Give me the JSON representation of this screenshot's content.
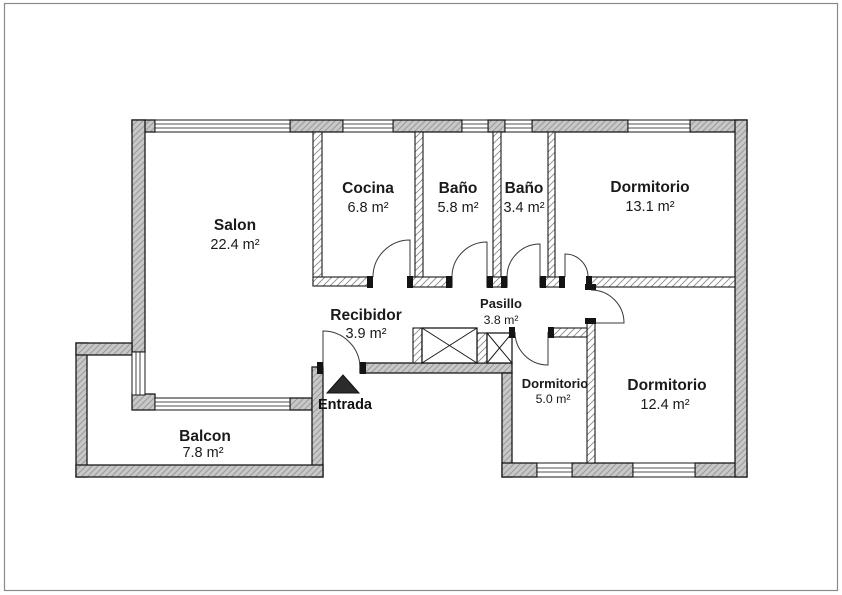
{
  "page": {
    "background": "#ffffff",
    "frame_border_color": "#8a8a8a"
  },
  "floor_plan": {
    "rooms": [
      {
        "id": "salon",
        "name": "Salon",
        "area": "22.4 m²"
      },
      {
        "id": "cocina",
        "name": "Cocina",
        "area": "6.8 m²"
      },
      {
        "id": "bano-1",
        "name": "Baño",
        "area": "5.8 m²"
      },
      {
        "id": "bano-2",
        "name": "Baño",
        "area": "3.4 m²"
      },
      {
        "id": "dormitorio-1",
        "name": "Dormitorio",
        "area": "13.1 m²"
      },
      {
        "id": "recibidor",
        "name": "Recibidor",
        "area": "3.9 m²"
      },
      {
        "id": "pasillo",
        "name": "Pasillo",
        "area": "3.8 m²"
      },
      {
        "id": "dormitorio-2",
        "name": "Dormitorio",
        "area": "5.0 m²"
      },
      {
        "id": "dormitorio-3",
        "name": "Dormitorio",
        "area": "12.4 m²"
      },
      {
        "id": "balcon",
        "name": "Balcon",
        "area": "7.8 m²"
      }
    ],
    "entrance": {
      "label": "Entrada"
    },
    "colors": {
      "wall_fill": "#c8c8c8",
      "wall_hatch": "#9a9a9a",
      "interior_wall_fill": "#ffffff",
      "interior_wall_hatch": "#8a8a8a",
      "outline": "#1a1a1a",
      "door_arc": "#3a3a3a",
      "text": "#1a1a1a",
      "entrance_marker": "#2b2b2b"
    }
  }
}
